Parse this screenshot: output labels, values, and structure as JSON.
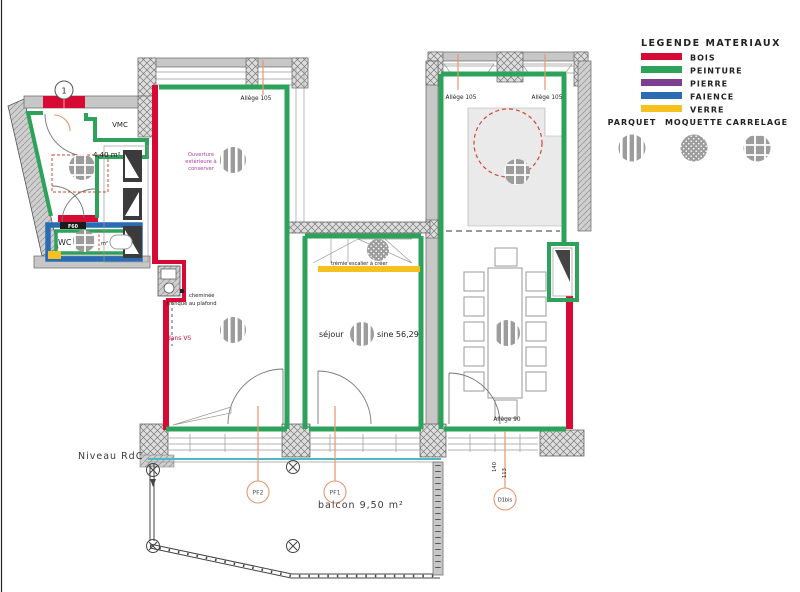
{
  "colors": {
    "bois": "#d60a35",
    "peinture": "#2ca25b",
    "pierre": "#7b3e90",
    "faience": "#2a6cb3",
    "verre": "#f4c11f",
    "marker": "#e9966f",
    "note": "#b23a9c",
    "teal": "#4db9c4",
    "dashred": "#d14936"
  },
  "legend": {
    "title": "LEGENDE MATERIAUX",
    "materials": [
      {
        "label": "BOIS",
        "key": "bois"
      },
      {
        "label": "PEINTURE",
        "key": "peinture"
      },
      {
        "label": "PIERRE",
        "key": "pierre"
      },
      {
        "label": "FAIENCE",
        "key": "faience"
      },
      {
        "label": "VERRE",
        "key": "verre"
      }
    ],
    "floorings": [
      {
        "label": "PARQUET",
        "pattern": "parquet"
      },
      {
        "label": "MOQUETTE",
        "pattern": "moquette"
      },
      {
        "label": "CARRELAGE",
        "pattern": "carrelage"
      }
    ]
  },
  "plan": {
    "level_label": "Niveau RdC",
    "rooms": {
      "vmc": "VMC",
      "entree_area": "4,40 m²",
      "wc": "WC",
      "wc_area": "m²",
      "sejour": "séjour",
      "sejour_area": "sine 56,29",
      "balcon": "balcon 9,50 m²"
    },
    "notes": {
      "ouverture": [
        "Ouverture",
        "extérieure à",
        "conserver"
      ],
      "cheminee_1": "cheminée",
      "cheminee_2": "tronqué au plafond",
      "dans_vs": "dans VS",
      "tremie": "trémie escalier à créer",
      "f60": "F60"
    },
    "dims": {
      "allege_entree": "Allège 105",
      "allege_right_a": "Allège 105",
      "allege_right_b": "Allège 105",
      "allege_90": "Allège 90",
      "d140": "140",
      "d113": "113"
    },
    "markers": {
      "m1": "1",
      "pf2": "PF2",
      "pf1": "PF1",
      "d1bis": "D1bis"
    }
  }
}
